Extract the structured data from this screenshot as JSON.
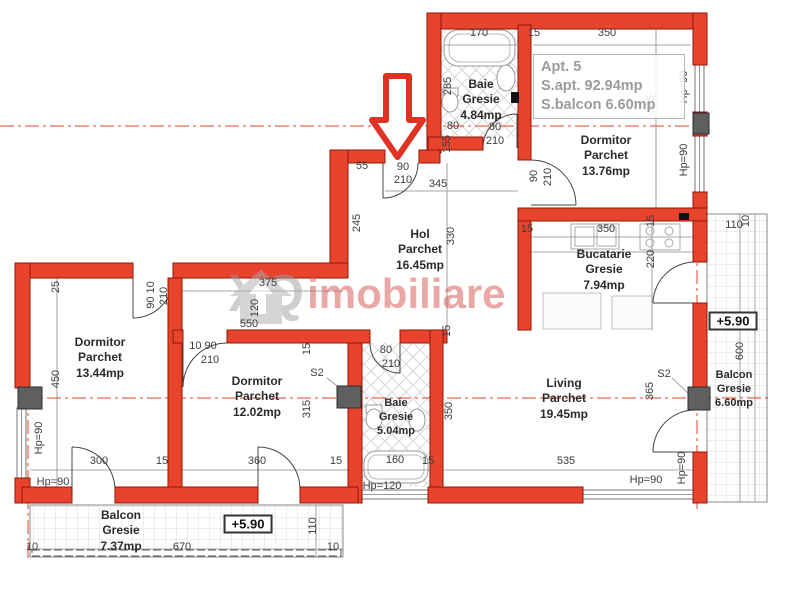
{
  "info_box": {
    "title": "Apt. 5",
    "apartment_area": "S.apt. 92.94mp",
    "balcony_area": "S.balcon 6.60mp"
  },
  "watermark": {
    "logo": "house-arrow-icon",
    "text_gray": "XQ",
    "text_red": "imobiliare"
  },
  "rooms": [
    {
      "name": "Baie",
      "floor": "Gresie",
      "area": "4.84mp"
    },
    {
      "name": "Dormitor",
      "floor": "Parchet",
      "area": "13.76mp"
    },
    {
      "name": "Hol",
      "floor": "Parchet",
      "area": "16.45mp"
    },
    {
      "name": "Bucatarie",
      "floor": "Gresie",
      "area": "7.94mp"
    },
    {
      "name": "Dormitor",
      "floor": "Parchet",
      "area": "13.44mp"
    },
    {
      "name": "Dormitor",
      "floor": "Parchet",
      "area": "12.02mp"
    },
    {
      "name": "Baie",
      "floor": "Gresie",
      "area": "5.04mp"
    },
    {
      "name": "Living",
      "floor": "Parchet",
      "area": "19.45mp"
    },
    {
      "name": "Balcon",
      "floor": "Gresie",
      "area": "6.60mp"
    },
    {
      "name": "Balcon",
      "floor": "Gresie",
      "area": "7.37mp"
    }
  ],
  "levels": [
    "+5.90",
    "+5.90"
  ],
  "dims": [
    "170",
    "15",
    "350",
    "285",
    "395",
    "Hp=90",
    "Hp=90",
    "80",
    "155",
    "80",
    "210",
    "90",
    "210",
    "55",
    "90",
    "210",
    "345",
    "245",
    "330",
    "15",
    "350",
    "15",
    "220",
    "110",
    "10",
    "600",
    "Hp=90",
    "S2",
    "365",
    "375",
    "120",
    "550",
    "15",
    "25",
    "90 10",
    "210",
    "450",
    "Hp=90",
    "Hp=90",
    "300",
    "15",
    "10 90",
    "210",
    "S2",
    "15",
    "315",
    "360",
    "15",
    "80",
    "210",
    "160",
    "15",
    "Hp=120",
    "350",
    "535",
    "Hp=90",
    "10",
    "670",
    "10",
    "110"
  ],
  "colors": {
    "wall_fill": "#e8432c",
    "wall_outline": "#8f1709",
    "center_line": "#e0402a",
    "pillar": "#5f5f5f",
    "dim_text": "#3d3d3d",
    "room_text": "#2b2b2b",
    "info_text": "#9b9b9b",
    "watermark_gray": "#9e9e9e",
    "watermark_red": "#d4524e"
  }
}
